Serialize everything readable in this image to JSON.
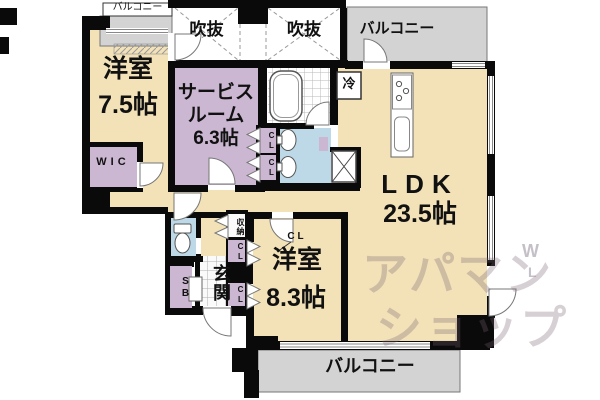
{
  "plan": {
    "balconies": {
      "top_left": "バルコニー",
      "top_right": "バルコニー",
      "bottom": "バルコニー"
    },
    "voids": {
      "void1": "吹抜",
      "void2": "吹抜"
    },
    "rooms": {
      "western1": {
        "name": "洋室",
        "size": "7.5帖"
      },
      "service": {
        "line1": "サービス",
        "line2": "ルーム",
        "size": "6.3帖"
      },
      "ldk": {
        "name": "LDK",
        "size": "23.5帖"
      },
      "western2": {
        "name": "洋室",
        "size": "8.3帖",
        "closet_label": "CL"
      },
      "wic": "WIC",
      "entrance": "玄関"
    },
    "fixtures": {
      "refrigerator": "冷",
      "shoe_box": "SB",
      "storage": "収納",
      "closet_a": "CL",
      "closet_b": "CL",
      "closet_c": "CL",
      "closet_d": "CL"
    }
  },
  "watermark": {
    "line1": "アパマン",
    "line2": "ショップ",
    "mark1": "W",
    "mark2": "L"
  },
  "colors": {
    "wall": "#0a0a0a",
    "room_cream": "#F3E2B8",
    "room_purple": "#CBB7D2",
    "room_blue": "#BDD9E8",
    "balcony_gray": "#D3D3D3",
    "watermark": "#8d7a8a"
  }
}
